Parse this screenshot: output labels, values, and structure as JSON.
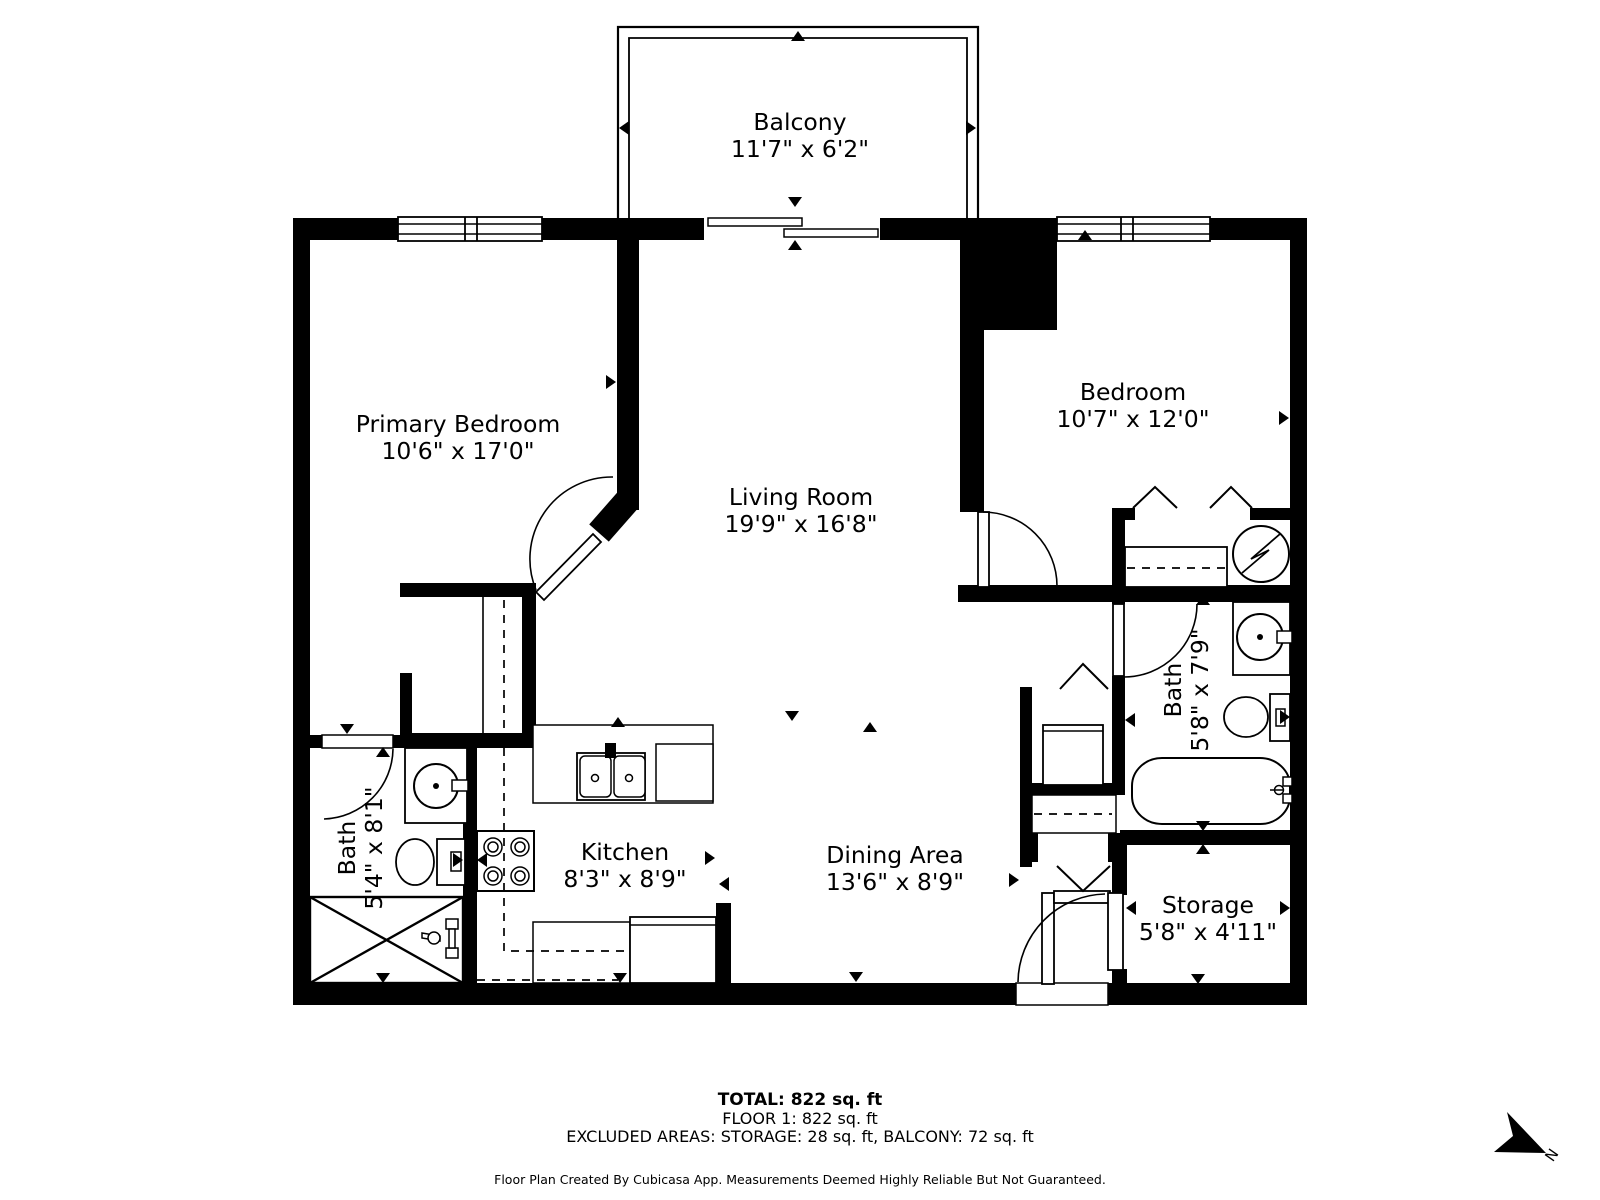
{
  "plan": {
    "rooms": {
      "balcony": {
        "name": "Balcony",
        "dims": "11'7\" x 6'2\""
      },
      "primary_bedroom": {
        "name": "Primary Bedroom",
        "dims": "10'6\" x 17'0\""
      },
      "living_room": {
        "name": "Living Room",
        "dims": "19'9\" x 16'8\""
      },
      "bedroom": {
        "name": "Bedroom",
        "dims": "10'7\" x 12'0\""
      },
      "bath_main": {
        "name": "Bath",
        "dims": "5'8\" x 7'9\""
      },
      "bath_second": {
        "name": "Bath",
        "dims": "5'4\" x 8'1\""
      },
      "kitchen": {
        "name": "Kitchen",
        "dims": "8'3\" x 8'9\""
      },
      "dining_area": {
        "name": "Dining Area",
        "dims": "13'6\" x 8'9\""
      },
      "storage": {
        "name": "Storage",
        "dims": "5'8\" x 4'11\""
      }
    },
    "summary": {
      "total": "TOTAL: 822 sq. ft",
      "floor": "FLOOR 1: 822 sq. ft",
      "excluded": "EXCLUDED AREAS: STORAGE: 28 sq. ft, BALCONY: 72 sq. ft"
    },
    "disclaimer": "Floor Plan Created By Cubicasa App. Measurements Deemed Highly Reliable But Not Guaranteed.",
    "compass": {
      "label": "N"
    },
    "colors": {
      "wall": "#000000",
      "background": "#ffffff",
      "text": "#000000"
    }
  }
}
